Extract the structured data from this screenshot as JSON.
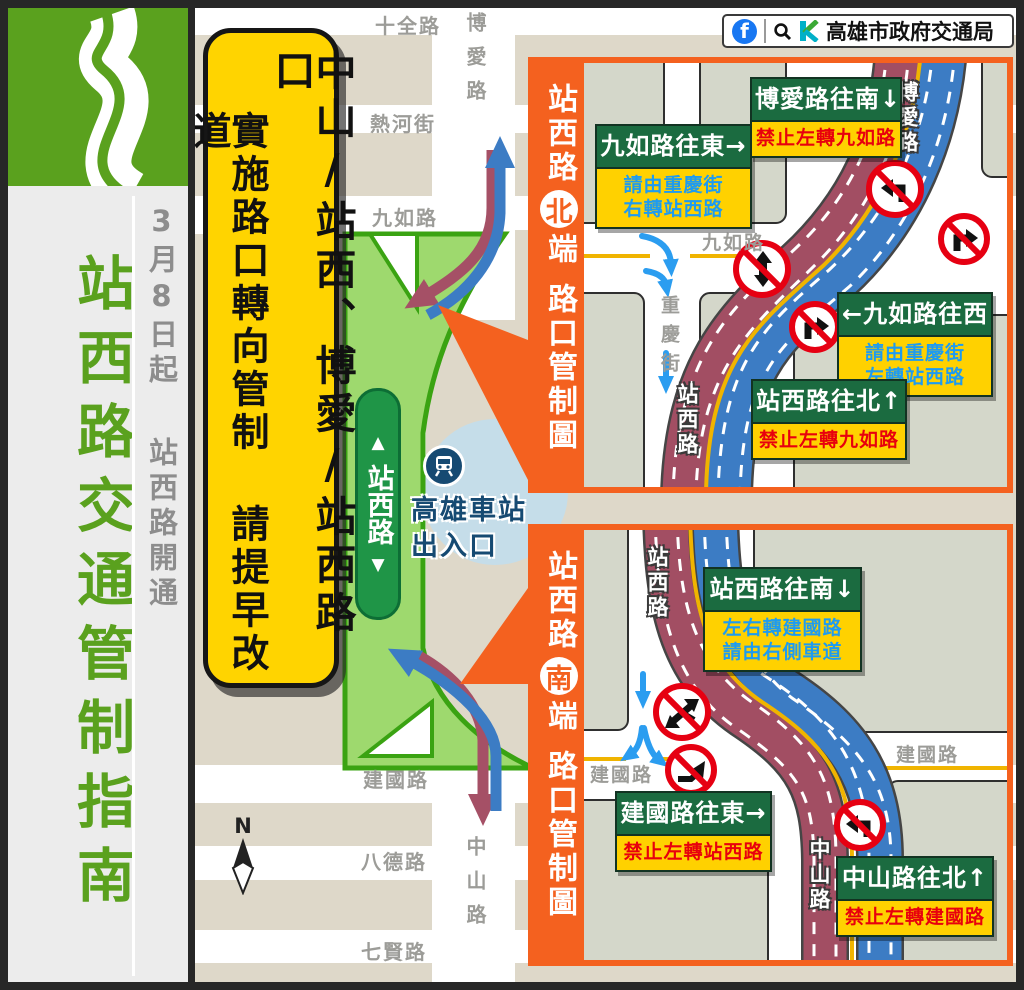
{
  "colors": {
    "accent_orange": "#f4611f",
    "sidebar_green": "#5aa11e",
    "banner_yellow": "#ffd400",
    "sign_green": "#1b6b40",
    "sign_yellow": "#ffd100",
    "sub_blue": "#1e9bf0",
    "sub_red": "#e8000d",
    "road_red": "#a24e63",
    "road_blue": "#3c7cc4",
    "arrow_blue": "#2b9df0",
    "map_beige": "#ded8c9",
    "block_gray": "#d4d7ca",
    "station_navy": "#164a72",
    "station_blue": "#c5dde9",
    "label_gray": "#9c9c98",
    "prohibit_red": "#e60012",
    "facebook_blue": "#1877f2",
    "yellow_line": "#f0b400"
  },
  "sidebar": {
    "title": "站西路交通管制指南",
    "date": "3月8日起",
    "note": "站西路開通"
  },
  "notice": {
    "line_right": "中山/站西、博愛/站西路口",
    "line_left": "實施路口轉向管制 請提早改道"
  },
  "header": {
    "agency": "高雄市政府交通局",
    "facebook_label": "f"
  },
  "map": {
    "labels": {
      "shiquan": "十全路",
      "rehe": "熱河街",
      "jiuru": "九如路",
      "boai": "博愛路",
      "jianguo": "建國路",
      "bade": "八德路",
      "qixian": "七賢路",
      "zhongshan": "中山路"
    },
    "zhanxi_sign": "站西路",
    "station": {
      "line1": "高雄車站",
      "line2": "出入口"
    },
    "compass": "N"
  },
  "inset_north": {
    "banner": {
      "road": "站西路",
      "end_circle": "北",
      "end": "端",
      "suffix": "路口管制圖"
    },
    "roads": {
      "jiuru": "九如路",
      "chongqing": "重慶街",
      "boai": "博愛路",
      "zhanxi": "站西路"
    },
    "signs": [
      {
        "title": "九如路往東→",
        "sub": "請由重慶街\n右轉站西路",
        "style": "blue"
      },
      {
        "title": "博愛路往南↓",
        "sub": "禁止左轉九如路",
        "style": "red"
      },
      {
        "title": "←九如路往西",
        "sub": "請由重慶街\n左轉站西路",
        "style": "blue"
      },
      {
        "title": "站西路往北↑",
        "sub": "禁止左轉九如路",
        "style": "red"
      }
    ]
  },
  "inset_south": {
    "banner": {
      "road": "站西路",
      "end_circle": "南",
      "end": "端",
      "suffix": "路口管制圖"
    },
    "roads": {
      "zhanxi": "站西路",
      "jianguo_w": "建國路",
      "jianguo_e": "建國路",
      "zhongshan": "中山路"
    },
    "signs": [
      {
        "title": "站西路往南↓",
        "sub": "左右轉建國路\n請由右側車道",
        "style": "blue"
      },
      {
        "title": "建國路往東→",
        "sub": "禁止左轉站西路",
        "style": "red"
      },
      {
        "title": "中山路往北↑",
        "sub": "禁止左轉建國路",
        "style": "red"
      }
    ]
  }
}
